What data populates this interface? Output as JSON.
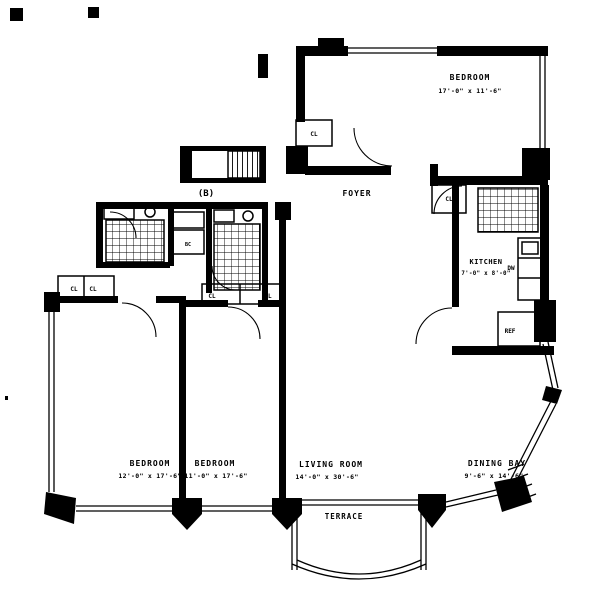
{
  "plan": {
    "unit_label": "(B)",
    "rooms": {
      "bedroom_top": {
        "name": "BEDROOM",
        "dims": "17'-0\" x 11'-6\""
      },
      "foyer": {
        "name": "FOYER"
      },
      "kitchen": {
        "name": "KITCHEN",
        "dims": "7'-0\" x 8'-0\""
      },
      "bedroom_left": {
        "name": "BEDROOM",
        "dims": "12'-0\" x 17'-6\""
      },
      "bedroom_mid": {
        "name": "BEDROOM",
        "dims": "11'-0\" x 17'-6\""
      },
      "living_room": {
        "name": "LIVING ROOM",
        "dims": "14'-0\" x 30'-6\""
      },
      "dining_bay": {
        "name": "DINING BAY",
        "dims": "9'-6\" x 14'-6\""
      },
      "terrace": {
        "name": "TERRACE"
      }
    },
    "fixtures": {
      "dishwasher": "DW",
      "refrigerator": "REF",
      "bath_closet": "BC"
    },
    "closet_label": "CL",
    "colors": {
      "ink": "#000000",
      "paper": "#ffffff"
    }
  }
}
